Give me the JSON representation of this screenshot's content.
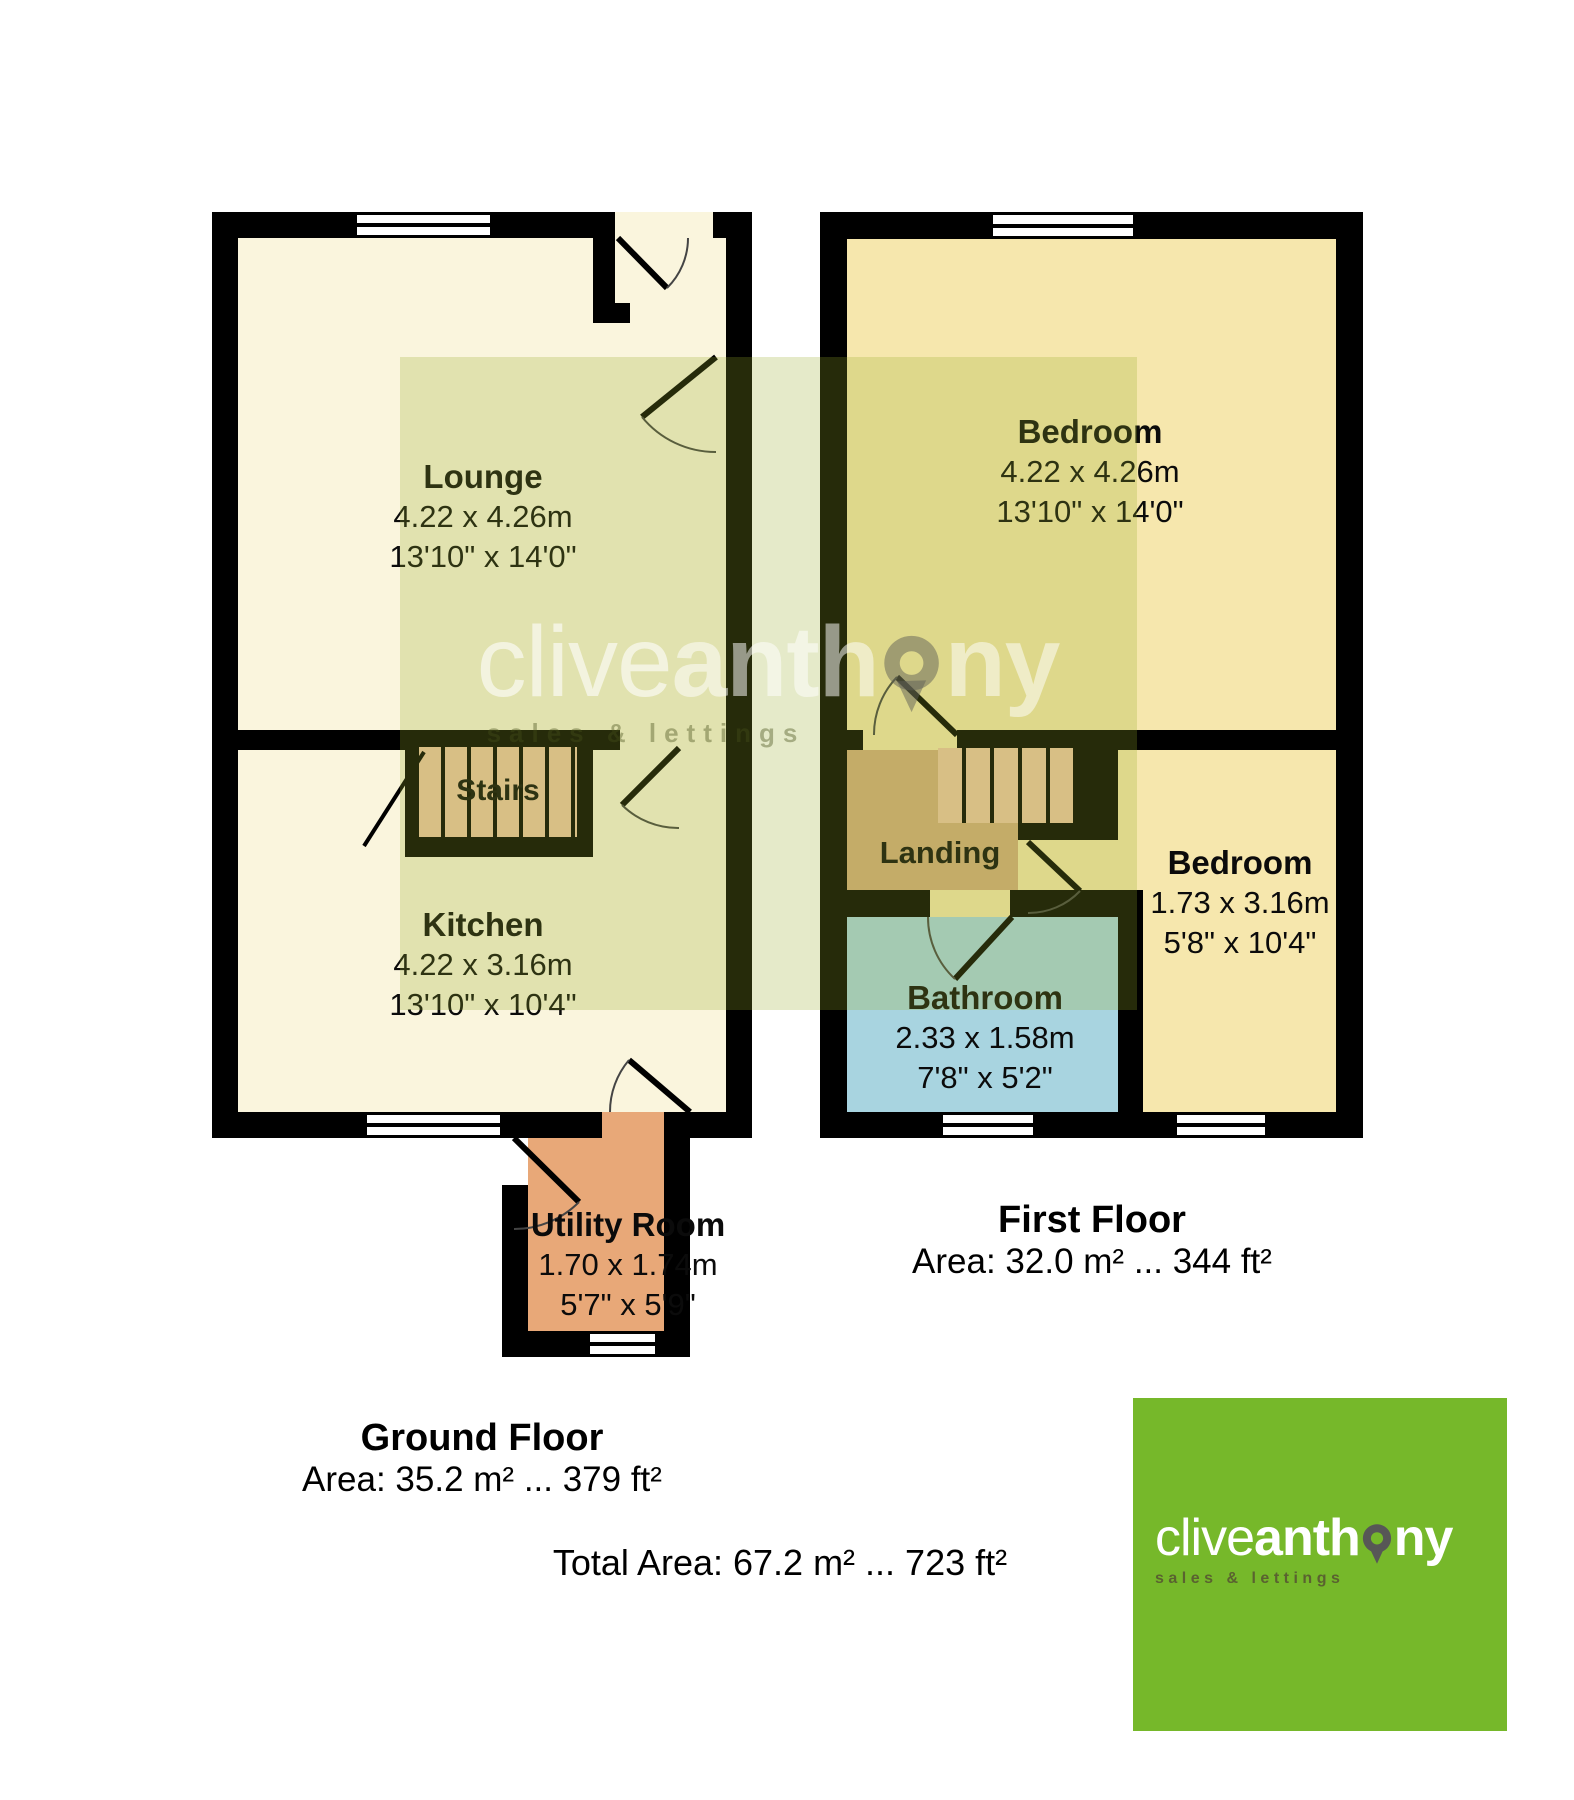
{
  "colors": {
    "brand_green": "#76b82a",
    "pin_gray": "#575756",
    "wall_black": "#000000",
    "ground_room_fill": "#faf5dd",
    "first_room_fill": "#f6e7ad",
    "stairs_fill": "#eec6a4",
    "landing_fill": "#d3ad7e",
    "utility_fill": "#e8a878",
    "bathroom_fill": "#a8d4e0",
    "watermark_tint": "rgba(150,170,40,0.25)"
  },
  "ground_floor": {
    "title": "Ground Floor",
    "area_label": "Area: 35.2 m² ... 379 ft²",
    "lounge": {
      "name": "Lounge",
      "dim_metric": "4.22 x 4.26m",
      "dim_imperial": "13'10\" x 14'0\""
    },
    "kitchen": {
      "name": "Kitchen",
      "dim_metric": "4.22 x 3.16m",
      "dim_imperial": "13'10\" x 10'4\""
    },
    "stairs": {
      "name": "Stairs"
    },
    "utility": {
      "name": "Utility Room",
      "dim_metric": "1.70 x 1.74m",
      "dim_imperial": "5'7\" x 5'9\""
    }
  },
  "first_floor": {
    "title": "First Floor",
    "area_label": "Area: 32.0 m² ... 344 ft²",
    "bedroom_main": {
      "name": "Bedroom",
      "dim_metric": "4.22 x 4.26m",
      "dim_imperial": "13'10\" x 14'0\""
    },
    "bedroom_small": {
      "name": "Bedroom",
      "dim_metric": "1.73 x 3.16m",
      "dim_imperial": "5'8\" x 10'4\""
    },
    "landing": {
      "name": "Landing"
    },
    "bathroom": {
      "name": "Bathroom",
      "dim_metric": "2.33 x 1.58m",
      "dim_imperial": "7'8\" x 5'2\""
    }
  },
  "total_area_label": "Total Area: 67.2 m² ... 723 ft²",
  "watermark": {
    "brand_light": "clive",
    "brand_bold_left": "anth",
    "brand_bold_right": "ny",
    "tagline": "sales & lettings"
  },
  "logo": {
    "brand_light": "clive",
    "brand_bold_left": "anth",
    "brand_bold_right": "ny",
    "tagline": "sales & lettings"
  }
}
